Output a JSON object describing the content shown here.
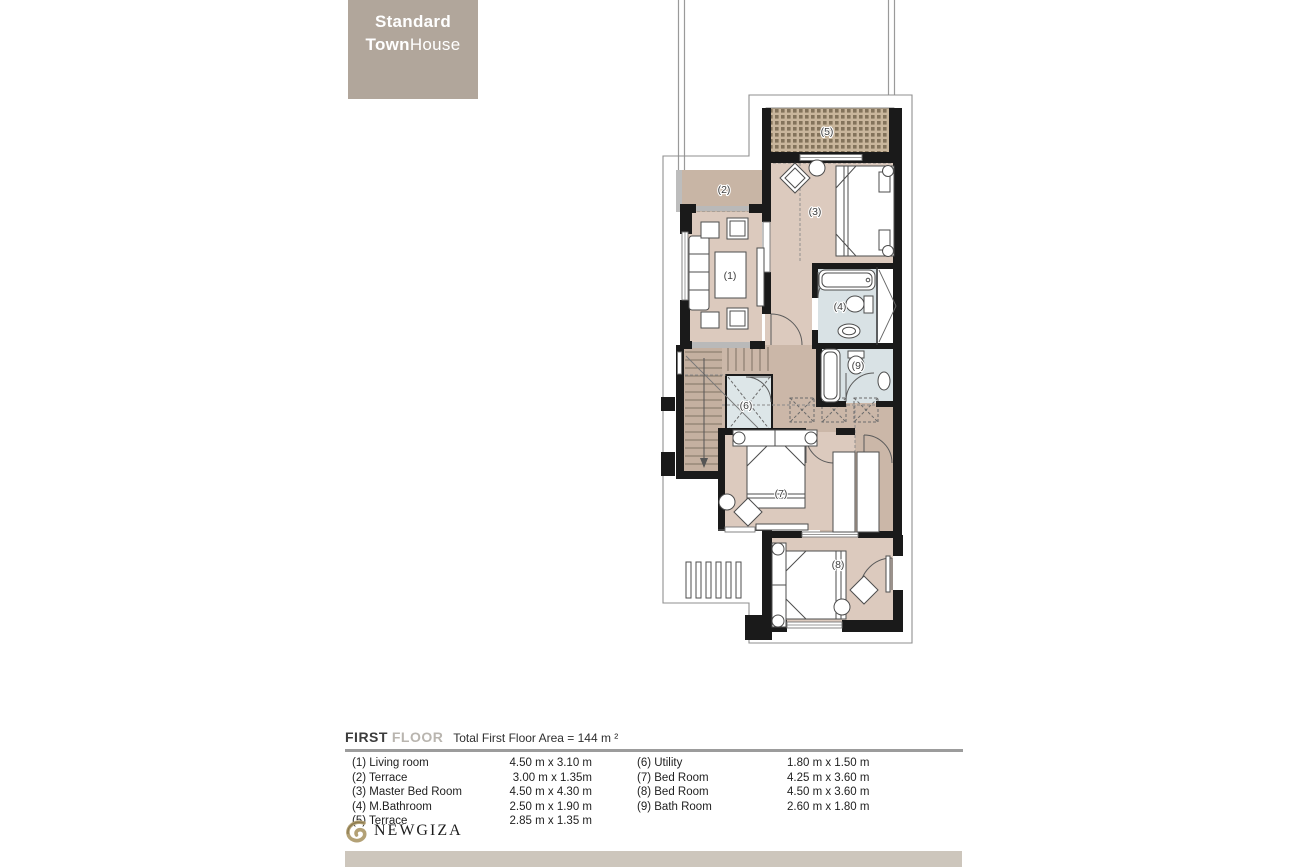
{
  "title_box": {
    "line1": "Standard",
    "line2_bold": "Town",
    "line2_light": "House"
  },
  "plan": {
    "room_labels": {
      "r1": "(1)",
      "r2": "(2)",
      "r3": "(3)",
      "r4": "(4)",
      "r5": "(5)",
      "r6": "(6)",
      "r7": "(7)",
      "r8": "(8)",
      "r9": "(9)"
    }
  },
  "legend": {
    "heading": {
      "first": "FIRST",
      "floor": "FLOOR",
      "area": "Total First Floor Area = 144 m ²"
    },
    "left": [
      {
        "label": "(1) Living room",
        "dims": "4.50 m x 3.10 m"
      },
      {
        "label": "(2) Terrace",
        "dims": "3.00 m x 1.35m"
      },
      {
        "label": "(3) Master Bed Room",
        "dims": "4.50 m x 4.30 m"
      },
      {
        "label": "(4) M.Bathroom",
        "dims": "2.50 m x 1.90 m"
      },
      {
        "label": "(5) Terrace",
        "dims": "2.85 m x 1.35 m"
      }
    ],
    "right": [
      {
        "label": "(6) Utility",
        "dims": "1.80 m  x 1.50 m"
      },
      {
        "label": "(7) Bed Room",
        "dims": "4.25 m x 3.60 m"
      },
      {
        "label": "(8) Bed Room",
        "dims": "4.50 m x 3.60 m"
      },
      {
        "label": "(9) Bath Room",
        "dims": "2.60 m  x 1.80 m"
      }
    ]
  },
  "footer": {
    "logo_text": "NEWGIZA"
  },
  "colors": {
    "accent_taupe": "#b1a69b",
    "floor_pink": "#dccabe",
    "corridor_taupe": "#cbb7a8",
    "terrace_dark": "#c8b5a5",
    "bath_blue": "#d9e2e5",
    "wall_black": "#1a1a1a",
    "bottom_bar": "#cdc6bc",
    "logo_gold": "#b3a176"
  }
}
